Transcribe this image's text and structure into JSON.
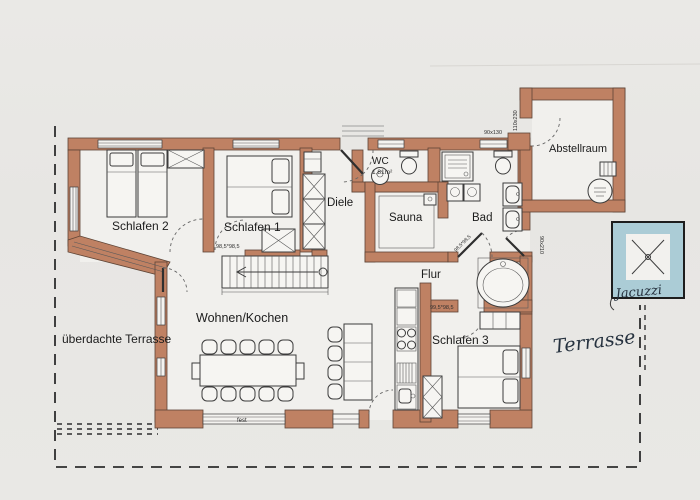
{
  "labels": {
    "schlafen2": "Schlafen 2",
    "schlafen1": "Schlafen 1",
    "schlafen3": "Schlafen 3",
    "diele": "Diele",
    "wc": "WC",
    "wc_area": "1,81m²",
    "sauna": "Sauna",
    "bad": "Bad",
    "flur": "Flur",
    "abstellraum": "Abstellraum",
    "wohnen_kochen": "Wohnen/Kochen",
    "ueberdachte_terrasse": "überdachte Terrasse",
    "terrasse": "Terrasse",
    "jacuzzi": "Jacuzzi"
  },
  "dimensions": {
    "top_window": "90x130",
    "storage_door": "110x230",
    "terrace_door": "90x210",
    "bedroom1_door": "98,5*98,5",
    "bath_door": "98,5*98,5",
    "bedroom3_door": "99,5*98,5",
    "fixed_window": "fest"
  },
  "colors": {
    "wall": "#bf8163",
    "paper": "#e8e7e4",
    "floor": "#f1f0ed",
    "jacuzzi_blue": "#abccd6",
    "ink": "#26323f",
    "line": "#3c3c3c"
  }
}
